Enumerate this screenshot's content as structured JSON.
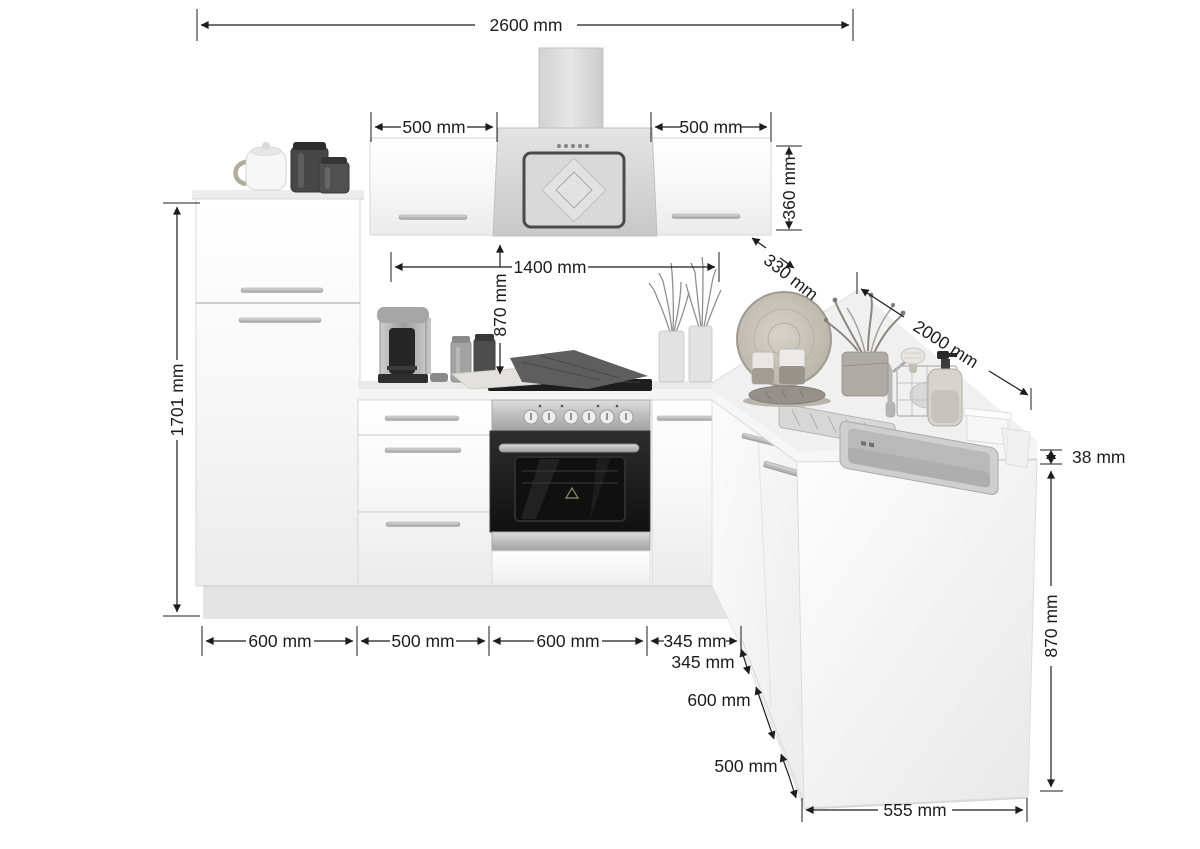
{
  "unit": "mm",
  "colors": {
    "dimension_line": "#1c1c1c",
    "background": "#ffffff",
    "cabinet_white": "#f5f5f5",
    "stainless_steel": "#b5b5b5",
    "oven_glass": "#141414"
  },
  "dimensions": {
    "total_width": "2600 mm",
    "left_wall_cabinet_width": "500 mm",
    "right_wall_cabinet_width": "500 mm",
    "wall_cabinet_height": "360 mm",
    "wall_cabinet_depth": "330 mm",
    "niche_width": "1400 mm",
    "niche_height": "870 mm",
    "tall_unit_height": "1701 mm",
    "peninsula_length": "2000 mm",
    "base_run_segments": [
      "600 mm",
      "500 mm",
      "600 mm",
      "345 mm"
    ],
    "peninsula_front_segments": [
      "345 mm",
      "600 mm",
      "500 mm"
    ],
    "peninsula_end_width": "555 mm",
    "worktop_thickness": "38 mm",
    "worktop_height": "870 mm"
  }
}
